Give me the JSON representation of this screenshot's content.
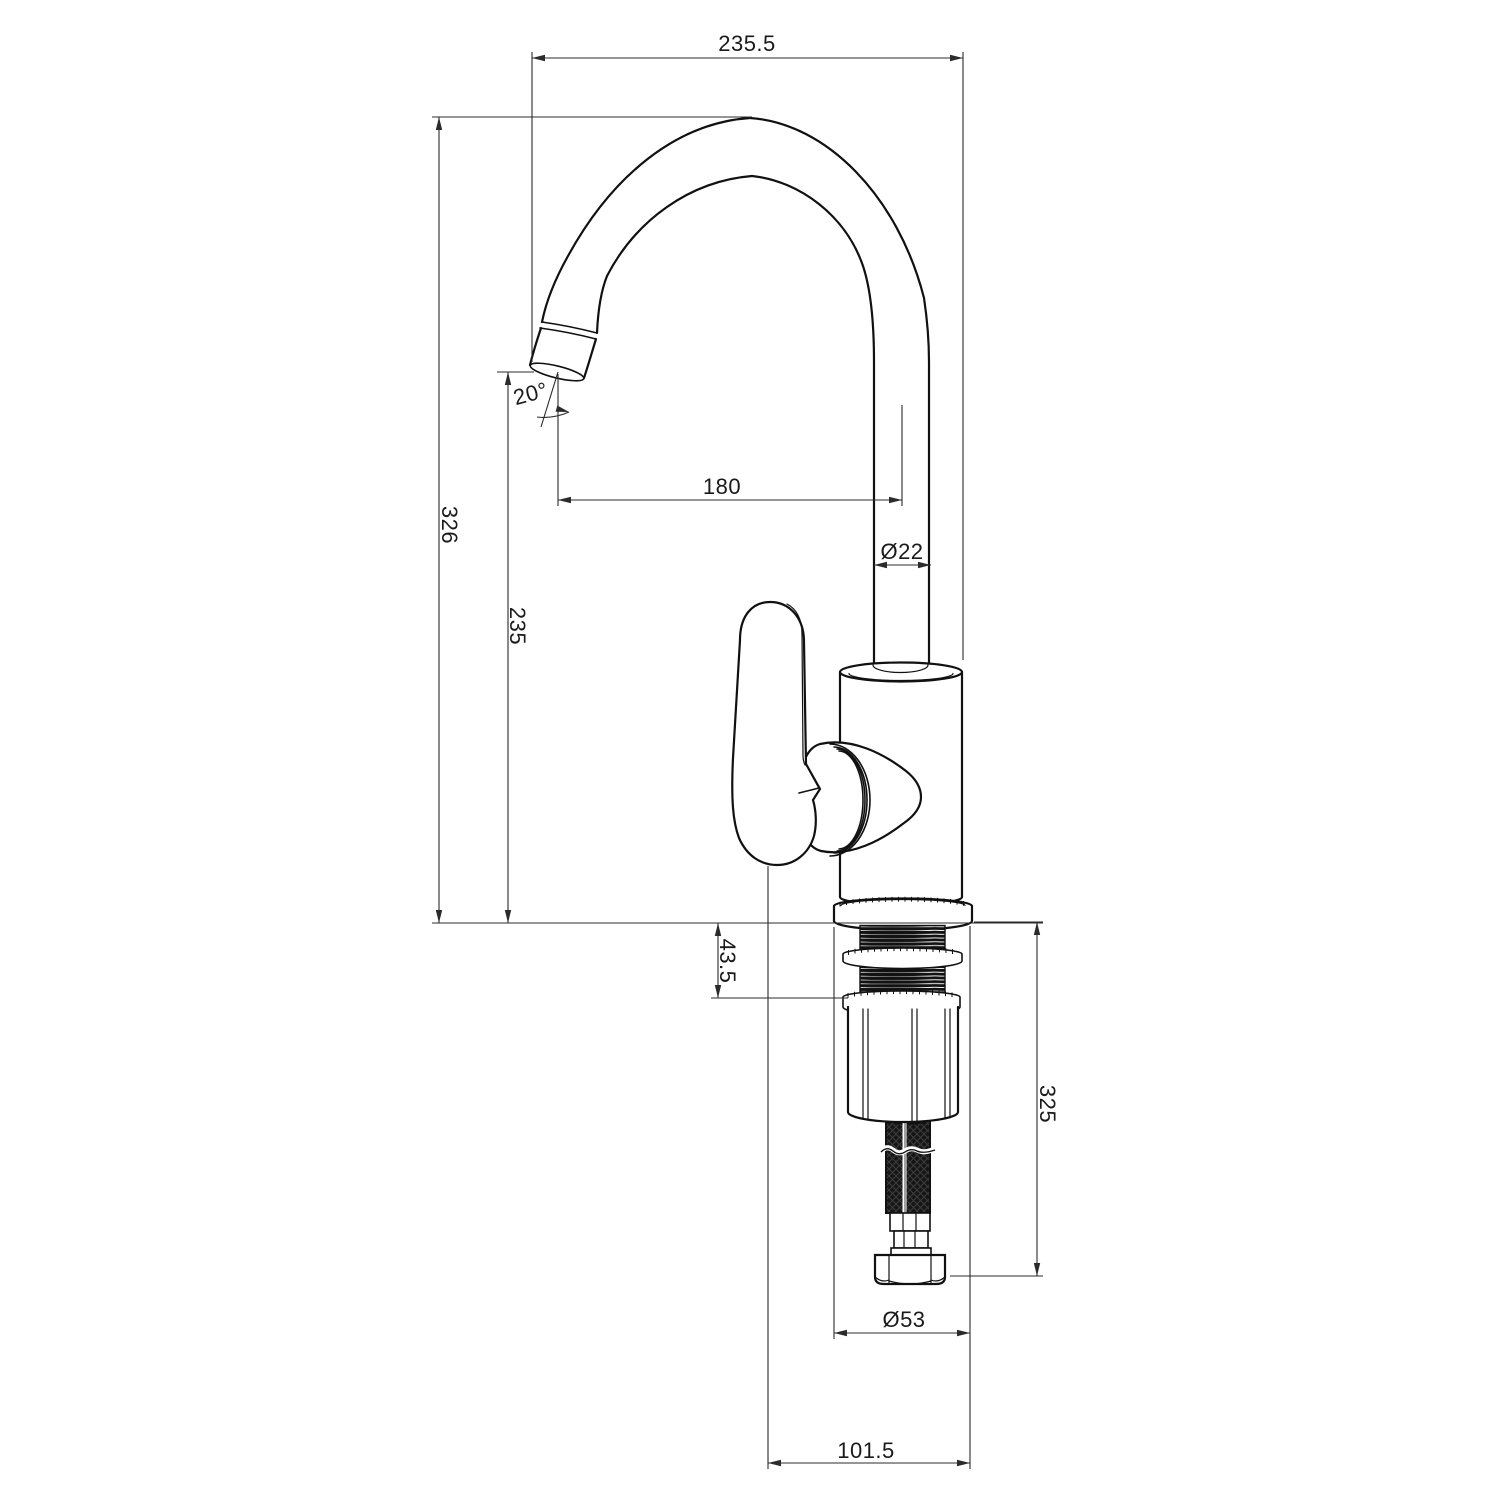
{
  "dimensions": {
    "overall_width": "235.5",
    "overall_height": "326",
    "spout_outlet_height": "235",
    "spout_reach": "180",
    "spout_tube_diameter": "Ø22",
    "outlet_angle": "20°",
    "mounting_thickness": "43.5",
    "under_counter_length": "325",
    "body_base_diameter": "Ø53",
    "base_footprint_width": "101.5"
  },
  "colors": {
    "line": "#1a1a1a",
    "background": "#ffffff",
    "hose": "#161616"
  }
}
